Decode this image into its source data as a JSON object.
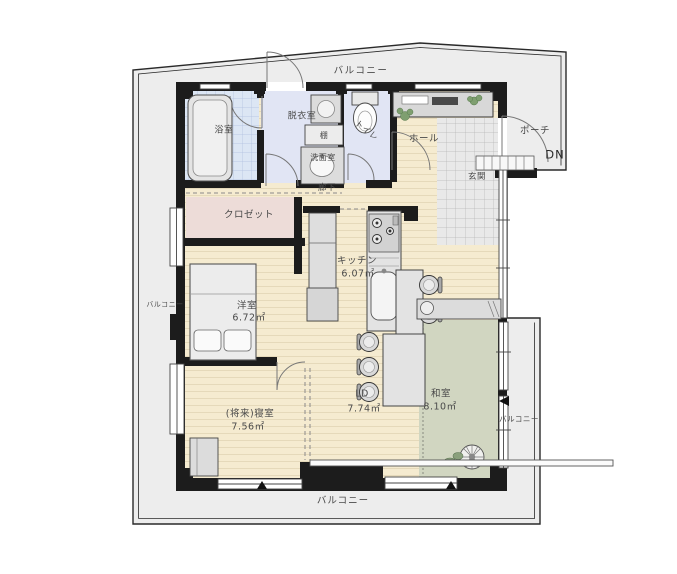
{
  "floorplan": {
    "rooms": {
      "balcony_top": {
        "label": "バルコニー"
      },
      "balcony_left": {
        "label": "バルコニー"
      },
      "balcony_right": {
        "label": "バルコニー"
      },
      "balcony_bottom": {
        "label": "バルコニー"
      },
      "bathroom": {
        "label": "浴室"
      },
      "dressing_room": {
        "label": "脱衣室"
      },
      "shelf": {
        "label": "棚"
      },
      "washroom": {
        "label": "洗面室"
      },
      "toilet": {
        "label": "トイレ"
      },
      "hall": {
        "label": "ホール"
      },
      "porch": {
        "label": "ポーチ"
      },
      "stair_down": {
        "label": "DN"
      },
      "entrance": {
        "label": "玄関"
      },
      "corridor": {
        "label": "廊下"
      },
      "closet": {
        "label": "クロゼット"
      },
      "kitchen": {
        "label": "キッチン",
        "area": "6.07㎡"
      },
      "western_room": {
        "label": "洋室",
        "area": "6.72㎡"
      },
      "future_bedroom": {
        "label": "(将来)寝室",
        "area": "7.56㎡"
      },
      "living_dining": {
        "label": "LD",
        "area": "7.74㎡"
      },
      "japanese_room": {
        "label": "和室",
        "area": "8.10㎡"
      }
    },
    "colors": {
      "wood_floor": "#f5ebd0",
      "tatami": "#d1d6c1",
      "closet_floor": "#eddcd8",
      "wet_area_floor": "#e1e5f4",
      "bath_tile": "#dce6f4",
      "entrance_tile": "#e9e9e9",
      "balcony": "#ededed",
      "wall": "#1c1c1c",
      "fixture": "#e3e3e3"
    }
  }
}
